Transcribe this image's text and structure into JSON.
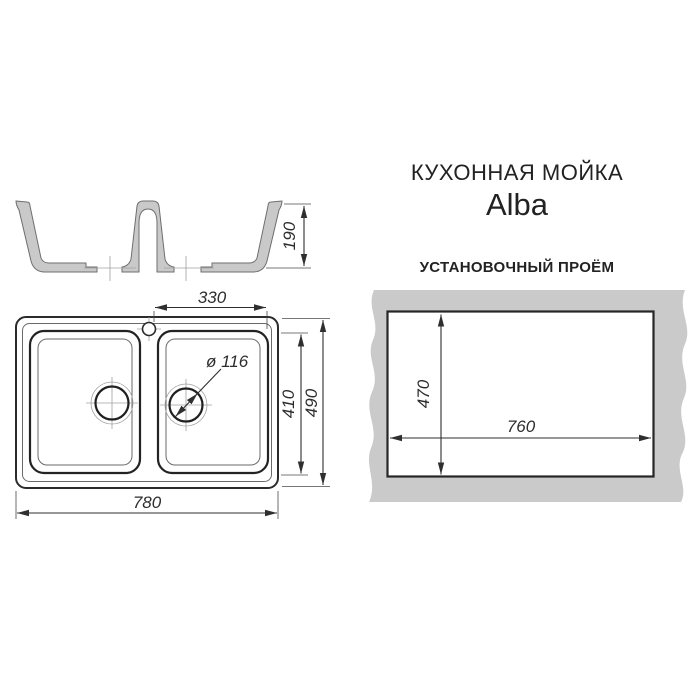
{
  "product": {
    "title": "КУХОННАЯ МОЙКА",
    "model": "Alba"
  },
  "section_view": {
    "depth": "190"
  },
  "top_view": {
    "bowl_span": "330",
    "drain_diameter": "ø 116",
    "bowl_depth": "410",
    "overall_depth": "490",
    "overall_width": "780"
  },
  "cutout": {
    "heading": "УСТАНОВОЧНЫЙ ПРОЁМ",
    "depth": "470",
    "width": "760"
  },
  "colors": {
    "line": "#2f2f2f",
    "bold_line": "#232323",
    "steel_fill": "#c9c9c9",
    "counter_fill": "#cacaca",
    "light_line": "#a0a0a0"
  }
}
